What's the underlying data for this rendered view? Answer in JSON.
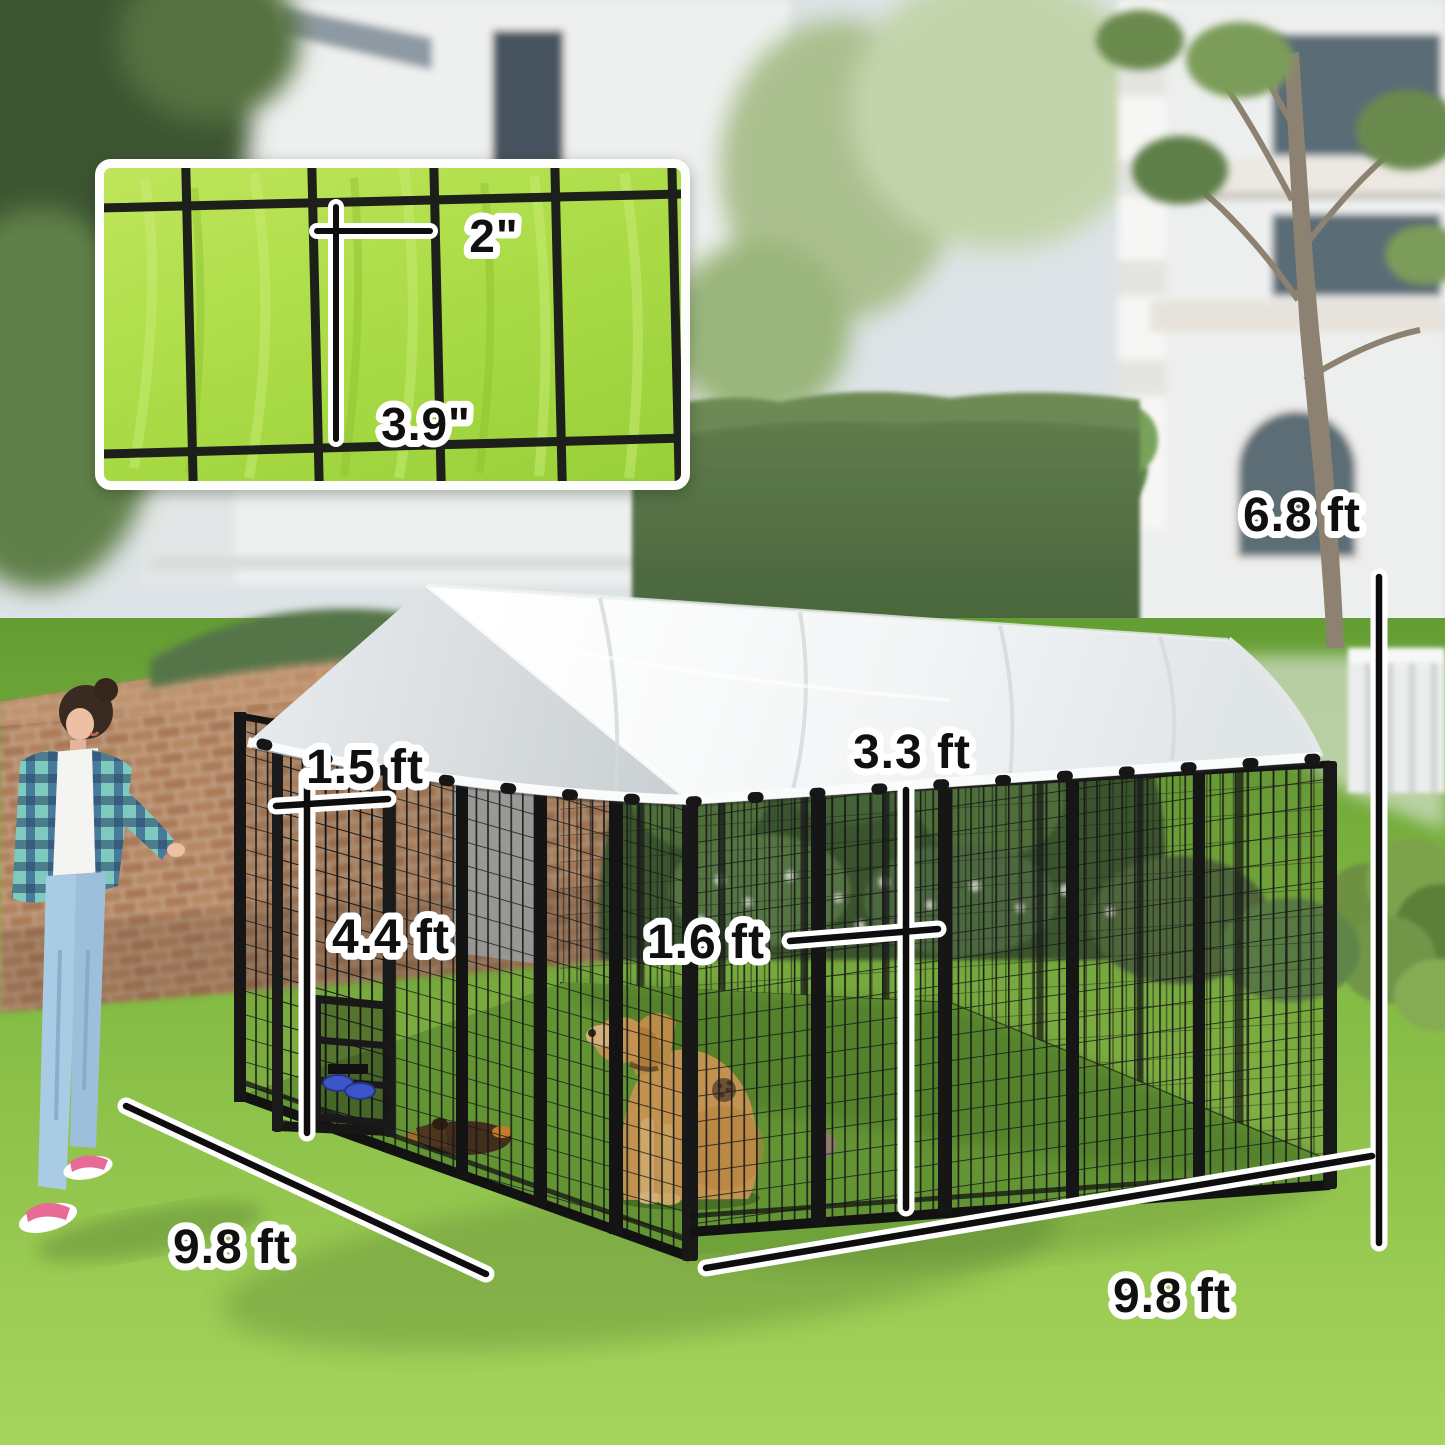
{
  "image_type": "product dimension photo",
  "subject": "outdoor dog kennel with white canopy roof in a backyard",
  "labels": {
    "inset_mesh_width": "2\"",
    "inset_mesh_height": "3.9\"",
    "gap_above_door": "1.5 ft",
    "door_height": "4.4 ft",
    "half_panel_width": "1.6 ft",
    "panel_width": "3.3 ft",
    "overall_height": "6.8 ft",
    "side_depth": "9.8 ft",
    "front_width": "9.8 ft"
  },
  "colors": {
    "lawn_green": "#8cc63e",
    "inset_grass": "#a8da44",
    "canopy_white": "#f4f6f6",
    "frame_black": "#151515",
    "dimension_line": "#0e0e0e",
    "dimension_outline": "#ffffff",
    "bowl_blue": "#3b55c8",
    "dog_golden": "#d7a158",
    "brick_tan": "#b08158"
  }
}
